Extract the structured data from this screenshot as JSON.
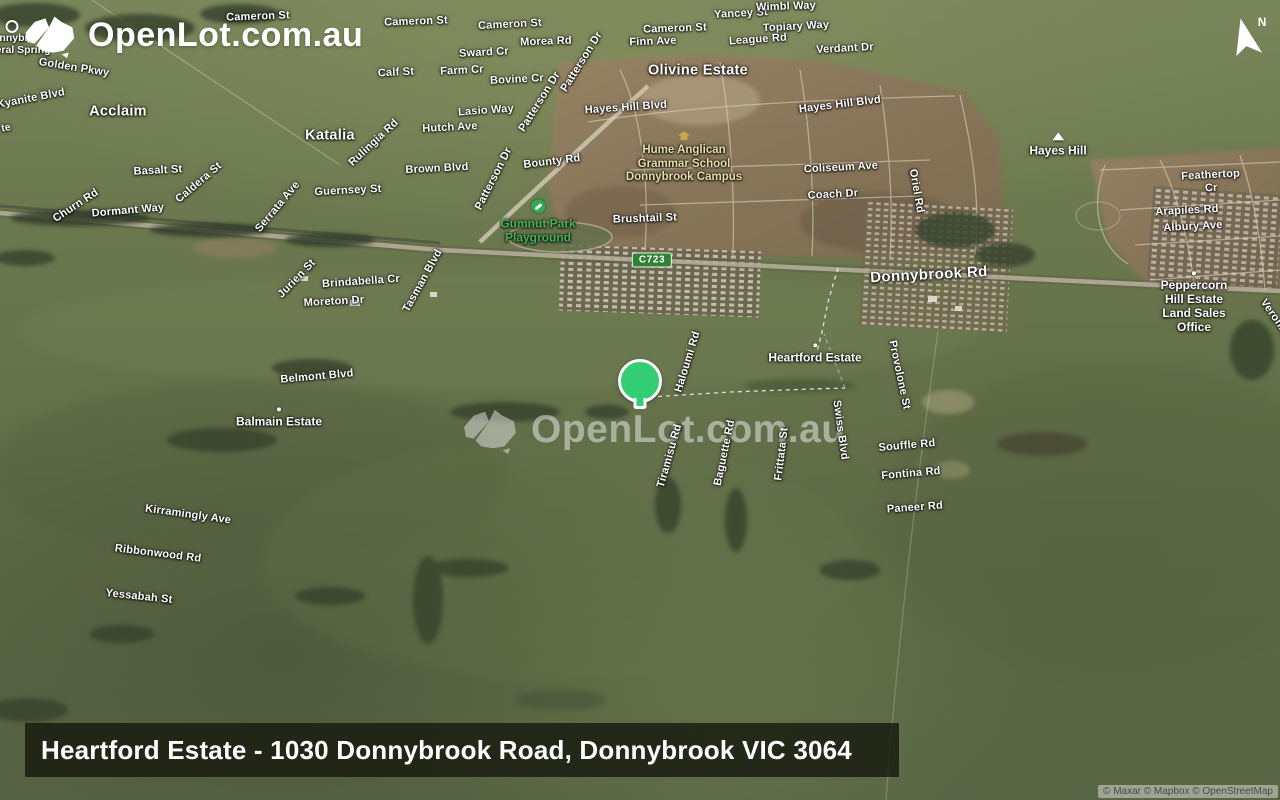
{
  "branding": {
    "logo_text": "OpenLot.com.au",
    "watermark_text": "OpenLot.com.au"
  },
  "compass": {
    "letter": "N"
  },
  "title_bar": {
    "text": "Heartford Estate - 1030 Donnybrook Road, Donnybrook VIC 3064"
  },
  "attribution": {
    "text": "© Maxar © Mapbox © OpenStreetMap"
  },
  "marker": {
    "color": "#33cd74",
    "outline": "#ffffff"
  },
  "map": {
    "route_shield": {
      "text": "C723",
      "fill": "#2e8135",
      "border": "#e9f2e6"
    },
    "colors": {
      "park_label": "#44b355",
      "school_label": "#e6dfa8",
      "road_label": "#ffffff"
    },
    "labels": [
      {
        "t": "Cameron St",
        "x": 258,
        "y": 17,
        "r": -2,
        "k": "road"
      },
      {
        "t": "Cameron St",
        "x": 416,
        "y": 22,
        "r": -2,
        "k": "road"
      },
      {
        "t": "Cameron St",
        "x": 510,
        "y": 25,
        "r": -3,
        "k": "road"
      },
      {
        "t": "Cameron St",
        "x": 675,
        "y": 29,
        "r": -2,
        "k": "road"
      },
      {
        "t": "Yancey St",
        "x": 741,
        "y": 14,
        "r": -3,
        "k": "road"
      },
      {
        "t": "Wimbl Way",
        "x": 786,
        "y": 7,
        "r": -2,
        "k": "road"
      },
      {
        "t": "Topiary Way",
        "x": 796,
        "y": 27,
        "r": -3,
        "k": "road"
      },
      {
        "t": "League Rd",
        "x": 758,
        "y": 40,
        "r": -4,
        "k": "road"
      },
      {
        "t": "Verdant Dr",
        "x": 845,
        "y": 49,
        "r": -3,
        "k": "road"
      },
      {
        "t": "Finn Ave",
        "x": 653,
        "y": 42,
        "r": -2,
        "k": "road"
      },
      {
        "t": "Morea Rd",
        "x": 546,
        "y": 42,
        "r": -2,
        "k": "road"
      },
      {
        "t": "Sward Cr",
        "x": 484,
        "y": 53,
        "r": -3,
        "k": "road"
      },
      {
        "t": "Calf St",
        "x": 396,
        "y": 73,
        "r": -3,
        "k": "road"
      },
      {
        "t": "Farm Cr",
        "x": 462,
        "y": 71,
        "r": -3,
        "k": "road"
      },
      {
        "t": "Bovine Cr",
        "x": 517,
        "y": 80,
        "r": -3,
        "k": "road"
      },
      {
        "t": "Lasio Way",
        "x": 486,
        "y": 111,
        "r": -4,
        "k": "road"
      },
      {
        "t": "Hutch Ave",
        "x": 450,
        "y": 128,
        "r": -3,
        "k": "road"
      },
      {
        "t": "Brown Blvd",
        "x": 437,
        "y": 169,
        "r": -3,
        "k": "road"
      },
      {
        "t": "Guernsey St",
        "x": 348,
        "y": 191,
        "r": -3,
        "k": "road"
      },
      {
        "t": "Golden Pkwy",
        "x": 74,
        "y": 68,
        "r": 9,
        "k": "road"
      },
      {
        "t": "Kyanite Blvd",
        "x": 31,
        "y": 99,
        "r": -11,
        "k": "road"
      },
      {
        "t": "Basalt St",
        "x": 158,
        "y": 171,
        "r": -3,
        "k": "road"
      },
      {
        "t": "Caldera St",
        "x": 199,
        "y": 183,
        "r": -40,
        "k": "road"
      },
      {
        "t": "Churn Rd",
        "x": 76,
        "y": 206,
        "r": -33,
        "k": "road"
      },
      {
        "t": "Dormant Way",
        "x": 128,
        "y": 211,
        "r": -5,
        "k": "road"
      },
      {
        "t": "Serrata Ave",
        "x": 278,
        "y": 207,
        "r": -50,
        "k": "road"
      },
      {
        "t": "Rulingia Rd",
        "x": 374,
        "y": 143,
        "r": -43,
        "k": "road"
      },
      {
        "t": "Patterson Dr",
        "x": 582,
        "y": 62,
        "r": -58,
        "k": "road"
      },
      {
        "t": "Patterson Dr",
        "x": 540,
        "y": 102,
        "r": -58,
        "k": "road"
      },
      {
        "t": "Patterson Dr",
        "x": 494,
        "y": 179,
        "r": -63,
        "k": "road"
      },
      {
        "t": "Bounty Rd",
        "x": 552,
        "y": 162,
        "r": -7,
        "k": "road"
      },
      {
        "t": "Hayes Hill Blvd",
        "x": 626,
        "y": 108,
        "r": -4,
        "k": "road"
      },
      {
        "t": "Hayes Hill Blvd",
        "x": 840,
        "y": 105,
        "r": -7,
        "k": "road"
      },
      {
        "t": "Coliseum Ave",
        "x": 841,
        "y": 168,
        "r": -3,
        "k": "road"
      },
      {
        "t": "Coach Dr",
        "x": 833,
        "y": 195,
        "r": -3,
        "k": "road"
      },
      {
        "t": "Oriel Rd",
        "x": 916,
        "y": 191,
        "r": 80,
        "k": "road"
      },
      {
        "t": "Brushtail St",
        "x": 645,
        "y": 219,
        "r": -2,
        "k": "road"
      },
      {
        "t": "Donnybrook Rd",
        "x": 929,
        "y": 275,
        "r": -3,
        "k": "road-lg"
      },
      {
        "t": "Jurien St",
        "x": 297,
        "y": 279,
        "r": -46,
        "k": "road"
      },
      {
        "t": "Brindabella Cr",
        "x": 361,
        "y": 282,
        "r": -4,
        "k": "road"
      },
      {
        "t": "Moreton Dr",
        "x": 334,
        "y": 302,
        "r": -3,
        "k": "road"
      },
      {
        "t": "Tasman Blvd",
        "x": 423,
        "y": 281,
        "r": -61,
        "k": "road"
      },
      {
        "t": "Belmont Blvd",
        "x": 317,
        "y": 377,
        "r": -5,
        "k": "road"
      },
      {
        "t": "Kirramingly Ave",
        "x": 188,
        "y": 515,
        "r": 8,
        "k": "road"
      },
      {
        "t": "Ribbonwood Rd",
        "x": 158,
        "y": 554,
        "r": 7,
        "k": "road"
      },
      {
        "t": "Yessabah St",
        "x": 139,
        "y": 597,
        "r": 6,
        "k": "road"
      },
      {
        "t": "Haloumi Rd",
        "x": 688,
        "y": 362,
        "r": -73,
        "k": "road"
      },
      {
        "t": "Tiramisu Rd",
        "x": 670,
        "y": 456,
        "r": -74,
        "k": "road"
      },
      {
        "t": "Baguette Rd",
        "x": 725,
        "y": 453,
        "r": -78,
        "k": "road"
      },
      {
        "t": "Frittata St",
        "x": 782,
        "y": 454,
        "r": -83,
        "k": "road"
      },
      {
        "t": "Swiss Blvd",
        "x": 840,
        "y": 430,
        "r": 82,
        "k": "road"
      },
      {
        "t": "Provolone St",
        "x": 899,
        "y": 375,
        "r": 78,
        "k": "road"
      },
      {
        "t": "Souffle Rd",
        "x": 907,
        "y": 446,
        "r": -5,
        "k": "road"
      },
      {
        "t": "Fontina Rd",
        "x": 911,
        "y": 474,
        "r": -5,
        "k": "road"
      },
      {
        "t": "Paneer Rd",
        "x": 915,
        "y": 508,
        "r": -4,
        "k": "road"
      },
      {
        "t": "Feathertop Cr",
        "x": 1211,
        "y": 182,
        "r": -3,
        "k": "road"
      },
      {
        "t": "Arapiles Rd",
        "x": 1187,
        "y": 211,
        "r": -3,
        "k": "road"
      },
      {
        "t": "Albury Ave",
        "x": 1193,
        "y": 227,
        "r": -3,
        "k": "road"
      },
      {
        "t": "Veronica",
        "x": 1276,
        "y": 320,
        "r": 55,
        "k": "road"
      },
      {
        "t": "te",
        "x": 6,
        "y": 128,
        "r": -10,
        "k": "frag"
      },
      {
        "t": "Acclaim",
        "x": 118,
        "y": 112,
        "r": 0,
        "k": "estate"
      },
      {
        "t": "Katalia",
        "x": 330,
        "y": 136,
        "r": 0,
        "k": "estate"
      },
      {
        "t": "Olivine Estate",
        "x": 698,
        "y": 71,
        "r": 0,
        "k": "estate"
      },
      {
        "t": "Heartford Estate",
        "x": 815,
        "y": 354,
        "r": 0,
        "k": "poi",
        "dot": true
      },
      {
        "t": "Balmain Estate",
        "x": 279,
        "y": 418,
        "r": 0,
        "k": "poi",
        "dot": true
      },
      {
        "t": "Peppercorn Hill Estate\nLand Sales Office",
        "x": 1194,
        "y": 303,
        "r": 0,
        "k": "poi",
        "dot": true
      },
      {
        "t": "Hayes Hill",
        "x": 1058,
        "y": 145,
        "r": 0,
        "k": "poi",
        "icon": "hill"
      },
      {
        "t": "Gumnut Park\nPlayground",
        "x": 538,
        "y": 222,
        "r": 0,
        "k": "poi-green",
        "icon": "playground"
      },
      {
        "t": "Hume Anglican\nGrammar School\nDonnybrook Campus",
        "x": 684,
        "y": 158,
        "r": 0,
        "k": "poi-yellow",
        "icon": "school"
      },
      {
        "t": "",
        "x": 12,
        "y": 28,
        "r": 0,
        "k": "frag",
        "icon": "spring"
      },
      {
        "t": "nnybr",
        "x": 14,
        "y": 38,
        "r": 0,
        "k": "frag"
      },
      {
        "t": "eral Spring",
        "x": 23,
        "y": 50,
        "r": 0,
        "k": "frag"
      }
    ]
  }
}
